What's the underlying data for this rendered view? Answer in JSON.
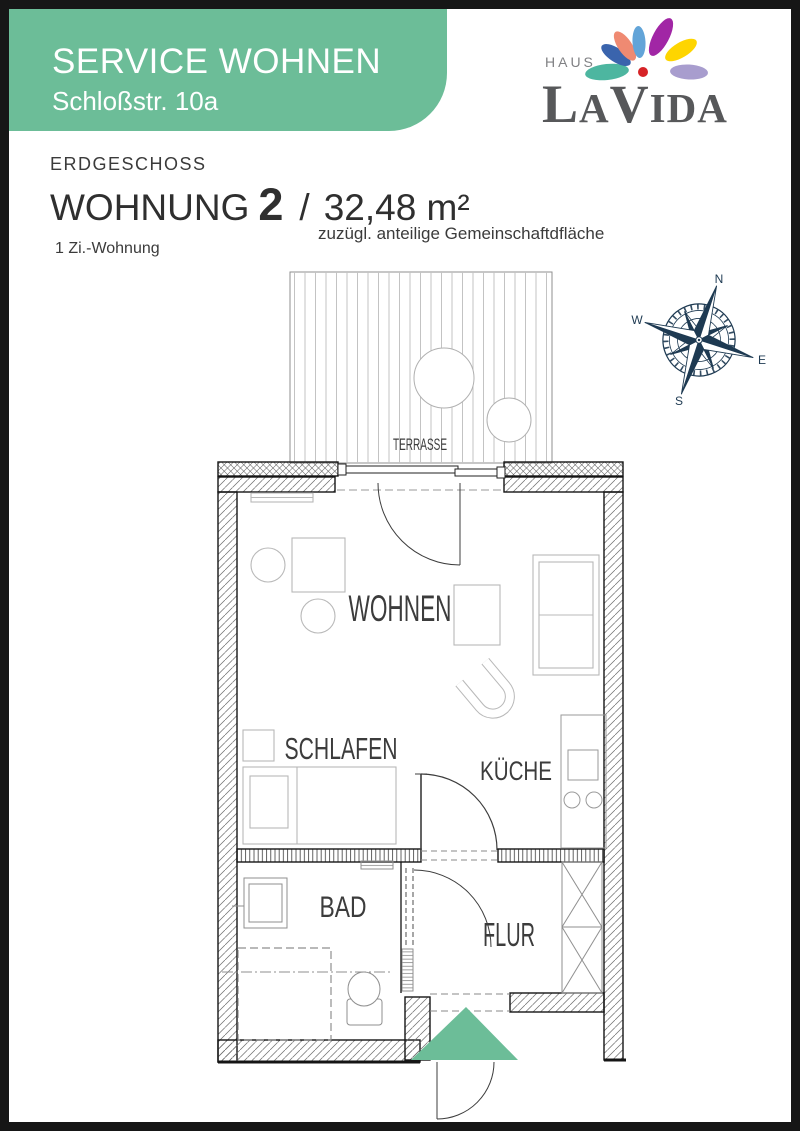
{
  "banner": {
    "title": "SERVICE WOHNEN",
    "subtitle": "Schloßstr. 10a"
  },
  "logo": {
    "haus": "HAUS",
    "name_l": "L",
    "name_a": "A",
    "name_v": "V",
    "name_ida": "IDA",
    "petals": [
      "#4db6a0",
      "#3a64ad",
      "#ef8a72",
      "#62a4d8",
      "#a126a5",
      "#fed500",
      "#a89dce"
    ],
    "center_dot": "#d62327"
  },
  "title_block": {
    "floor": "ERDGESCHOSS",
    "unit_label": "WOHNUNG",
    "unit_number": "2",
    "separator": "/",
    "area": "32,48 m²",
    "area_note": "zuzügl. anteilige Gemeinschaftdfläche",
    "apartment_type": "1 Zi.-Wohnung"
  },
  "rooms": {
    "wohnen": "WOHNEN",
    "schlafen": "SCHLAFEN",
    "kueche": "KÜCHE",
    "bad": "BAD",
    "flur": "FLUR",
    "terrasse": "TERRASSE"
  },
  "compass": {
    "n": "N",
    "e": "E",
    "s": "S",
    "w": "W",
    "color": "#1e3a52"
  },
  "colors": {
    "accent_green": "#6cbd98",
    "page_border": "#161616",
    "text_dark": "#3b3b3b",
    "logo_gray": "#57585a"
  }
}
